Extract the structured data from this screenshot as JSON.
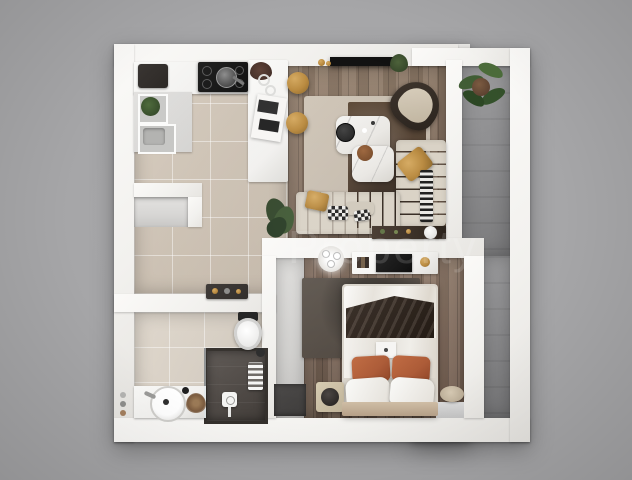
{
  "scene": {
    "type": "3d-floor-plan-render",
    "description": "Top-down photorealistic 3D render of a one-bedroom apartment with open kitchen-living area, bedroom, bathroom, entry hall and side balcony",
    "watermark": "Property"
  },
  "colors": {
    "bg": "#a6a6a8",
    "wall": "#f2f1ee",
    "kitchen_tile": "#cdc2b4",
    "bath_tile": "#d6cec3",
    "wood_living": "#846f5e",
    "wood_bedroom": "#7e685a",
    "stone": "#8e8e90",
    "hall_floor": "#d6d5d3",
    "doormat": "#3e3c3b",
    "rug_light": "#c3b8aa",
    "rug_dark": "#443428",
    "bedroom_rug": "#49413a",
    "sofa": "#d8d1c4",
    "gold": "#b8883c",
    "rust": "#ac5a36",
    "marble": "#e9e7e3",
    "white_fixture": "#f1f0ee",
    "dark_furniture": "#2b2724",
    "console_wood": "#32271e",
    "watermark": "rgba(255,255,255,0.14)"
  },
  "rooms": [
    {
      "name": "kitchen",
      "floor": "beige-tile",
      "items": [
        "coffee-machine",
        "induction-cooktop",
        "frying-pan",
        "sink-unit",
        "herb-plant",
        "island-counter",
        "bar-stool",
        "bar-stool",
        "open-magazine",
        "entry-bench"
      ]
    },
    {
      "name": "living-room",
      "floor": "wood-plank",
      "items": [
        "wall-tv",
        "accent-armchair",
        "two-tone-area-rug",
        "marble-coffee-table",
        "black-side-table",
        "leather-pouf",
        "l-shaped-sofa",
        "mustard-pillows",
        "checkered-pillows",
        "striped-throw",
        "console-sideboard",
        "floor-plant"
      ]
    },
    {
      "name": "bedroom",
      "floor": "wood-plank",
      "items": [
        "ceiling-light",
        "media-console",
        "tv",
        "dark-area-rug",
        "double-bed",
        "throw-blanket",
        "rust-pillows",
        "white-pillows",
        "nightstand",
        "round-speaker",
        "pouf",
        "window-sill"
      ]
    },
    {
      "name": "bathroom",
      "floor": "beige-tile",
      "items": [
        "toilet",
        "walk-in-shower",
        "rain-shower-head",
        "towel-radiator",
        "vanity-counter",
        "round-sink",
        "faucet",
        "dried-flowers",
        "toiletries"
      ]
    },
    {
      "name": "hallway",
      "floor": "gray-screed",
      "items": [
        "doormat"
      ]
    },
    {
      "name": "balcony",
      "floor": "stone-tile",
      "items": [
        "palm-plant"
      ]
    }
  ]
}
